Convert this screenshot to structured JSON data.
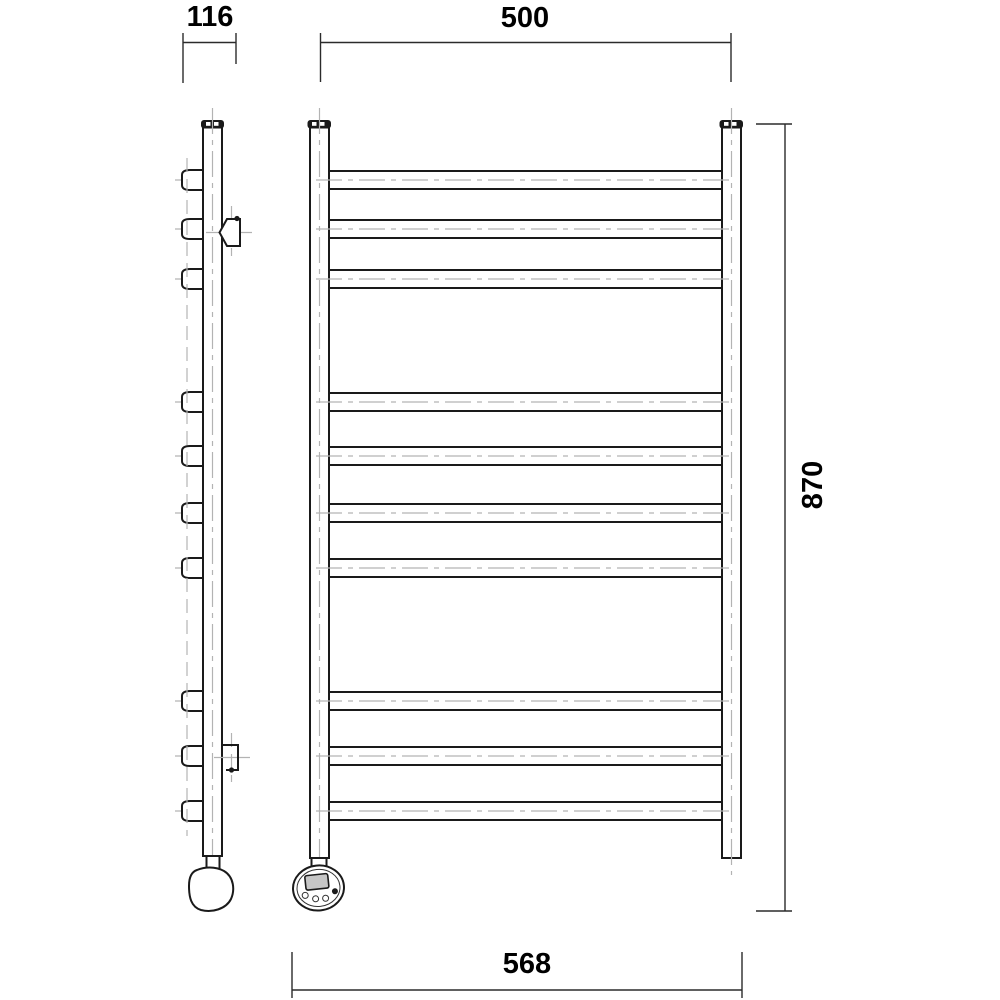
{
  "drawing": {
    "type": "technical-dimension-drawing",
    "subject": "ladder towel rail radiator, side view and front view",
    "colors": {
      "line": "#1a1a1a",
      "centerline": "#b3b3b3",
      "display_fill": "#c6c6c6",
      "background": "#ffffff"
    },
    "views": {
      "side_view": {
        "rung_count": 10,
        "wall_bracket_count": 2,
        "heating_element": "egg-shaped heater knob"
      },
      "front_view": {
        "rung_count": 10,
        "thermostat": {
          "display": true,
          "button_count": 4
        }
      }
    }
  },
  "dimensions": {
    "depth_mm": {
      "label": "116"
    },
    "center_width_mm": {
      "label": "500"
    },
    "height_mm": {
      "label": "870"
    },
    "overall_width_mm": {
      "label": "568"
    }
  }
}
